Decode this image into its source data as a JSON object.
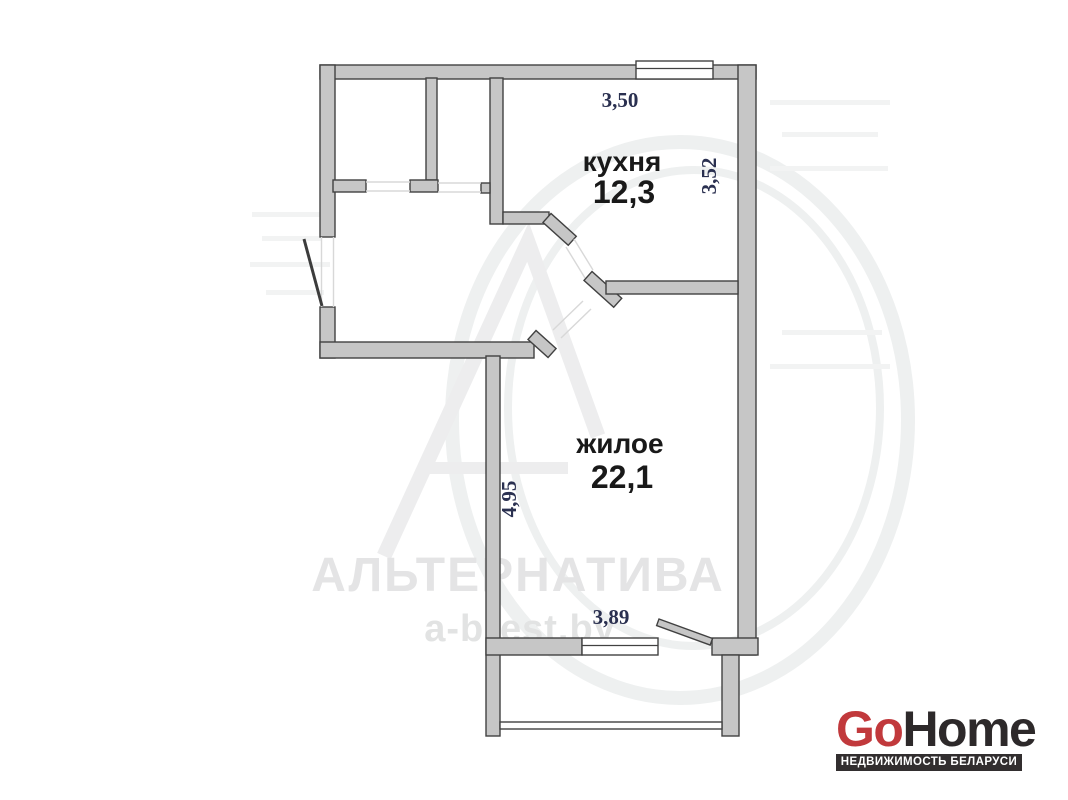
{
  "plan": {
    "rooms": [
      {
        "id": "kitchen",
        "label": "кухня",
        "area": "12,3",
        "width_m": "3,50",
        "depth_m": "3,52"
      },
      {
        "id": "living",
        "label": "жилое",
        "area": "22,1",
        "width_m": "3,89",
        "depth_m": "4,95"
      }
    ]
  },
  "watermark": {
    "company": "АЛЬТЕРНАТИВА",
    "website": "a-brest.by"
  },
  "logo": {
    "go": "Go",
    "home": "Home",
    "tagline": "НЕДВИЖИМОСТЬ БЕЛАРУСИ",
    "go_color": "#c1393c",
    "home_color": "#2d292a",
    "banner_color": "#322e2f"
  },
  "colors": {
    "wall_fill": "#c6c6c6",
    "wall_outline": "#414141",
    "dimension_text": "#2a3050",
    "room_text": "#191919",
    "watermark_text": "#e4e4e5"
  }
}
